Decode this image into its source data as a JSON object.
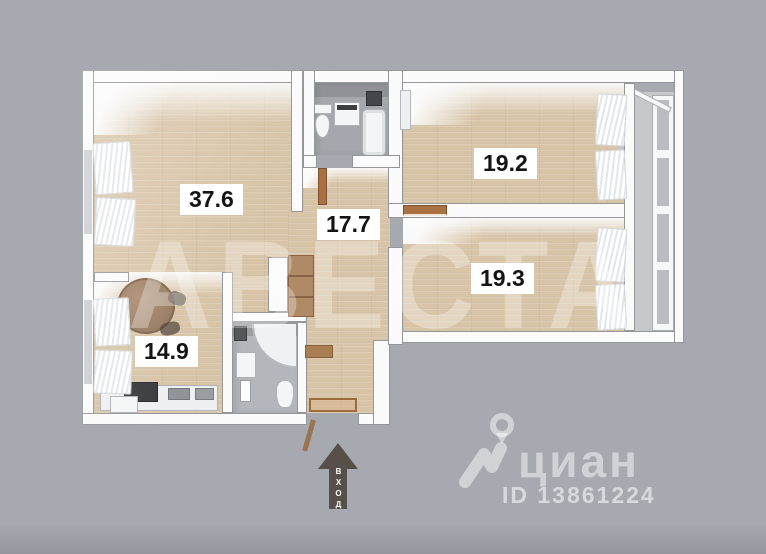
{
  "rooms": [
    {
      "name": "living-room",
      "area": "37.6"
    },
    {
      "name": "hallway",
      "area": "17.7"
    },
    {
      "name": "bedroom-1",
      "area": "19.2"
    },
    {
      "name": "bedroom-2",
      "area": "19.3"
    },
    {
      "name": "kitchen",
      "area": "14.9"
    }
  ],
  "entrance": {
    "label": "ВХОД"
  },
  "watermark": {
    "text": "АВЕСТА"
  },
  "branding": {
    "logo": "циан",
    "listing_id": "ID 13861224"
  },
  "colors": {
    "background": "#a7a9b1",
    "wood_floor": "#d8c4a6",
    "wall": "#fbfbfc",
    "tile_floor": "#a4a7ab",
    "door_brown": "#a9713f",
    "arrow": "#57504a",
    "label_bg": "#ffffff",
    "label_text": "#141414",
    "watermark_overlay": "rgba(255,255,255,0.30)"
  }
}
